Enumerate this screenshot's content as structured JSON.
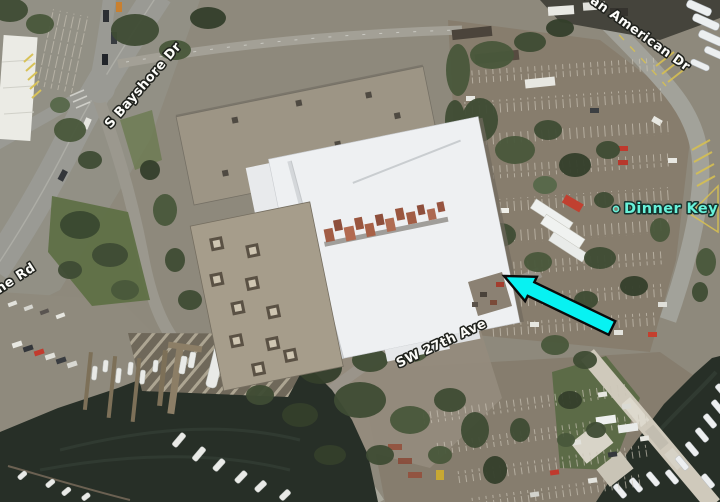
{
  "labels": {
    "s_bayshore_dr": "S Bayshore Dr",
    "pan_american_dr": "Pan American Dr",
    "mcfarlane_rd_partial": "ane Rd",
    "sw_27th_ave": "SW 27th Ave",
    "dinner_key": "Dinner Key"
  },
  "colors": {
    "annotation_arrow": "#07f2f2",
    "poi_label": "#68f2da",
    "road_label": "#fdfdfa",
    "water": "#272f27"
  }
}
